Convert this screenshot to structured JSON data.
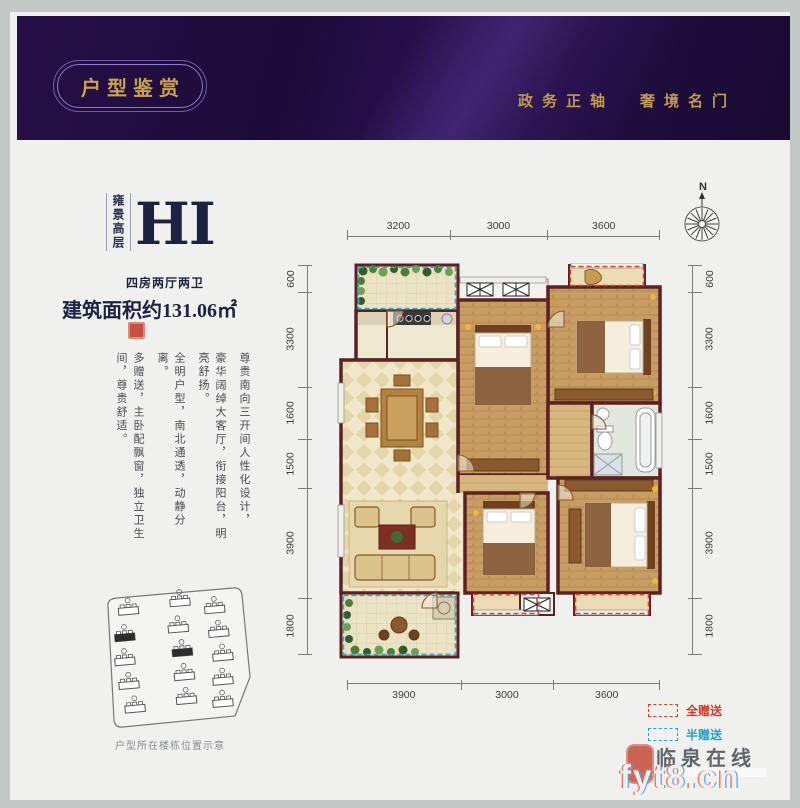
{
  "banner": {
    "title": "户型鉴赏",
    "slogan_left": "政务正轴",
    "slogan_right": "奢境名门"
  },
  "unit": {
    "series": "雍景高层",
    "code": "HI",
    "layout": "四房两厅两卫",
    "area_label": "建筑面积约131.06㎡"
  },
  "features": [
    "尊贵南向三开间人性化设计，",
    "豪华阔绰大客厅，衔接阳台，明亮舒扬。",
    "全明户型，南北通透，动静分离。",
    "多赠送，主卧配飘窗，独立卫生间，尊贵舒适。"
  ],
  "compass": {
    "north_label": "N"
  },
  "dimensions": {
    "top": [
      "3200",
      "3000",
      "3600"
    ],
    "bottom": [
      "3900",
      "3000",
      "3600"
    ],
    "left": [
      "600",
      "3300",
      "1600",
      "1500",
      "3900",
      "1800"
    ],
    "right": [
      "600",
      "3300",
      "1600",
      "1500",
      "3900",
      "1800"
    ]
  },
  "legend": [
    {
      "label": "全赠送",
      "color": "#cf3f2c"
    },
    {
      "label": "半赠送",
      "color": "#2f9fc8"
    }
  ],
  "site_plan": {
    "caption": "户型所在楼栋位置示意"
  },
  "watermark": {
    "site_name": "临泉在线",
    "logo": "fyt8.cn"
  },
  "colors": {
    "banner_purple": "#1d0b3a",
    "gold": "#c9a24f",
    "navy_text": "#1b2340",
    "wall_maroon": "#5c2122",
    "wood_floor": "#c79d63",
    "tile_floor": "#efe5c4",
    "plant_green": "#3f6b35",
    "full_gift_red": "#cf3f2c",
    "half_gift_blue": "#2f9fc8"
  }
}
